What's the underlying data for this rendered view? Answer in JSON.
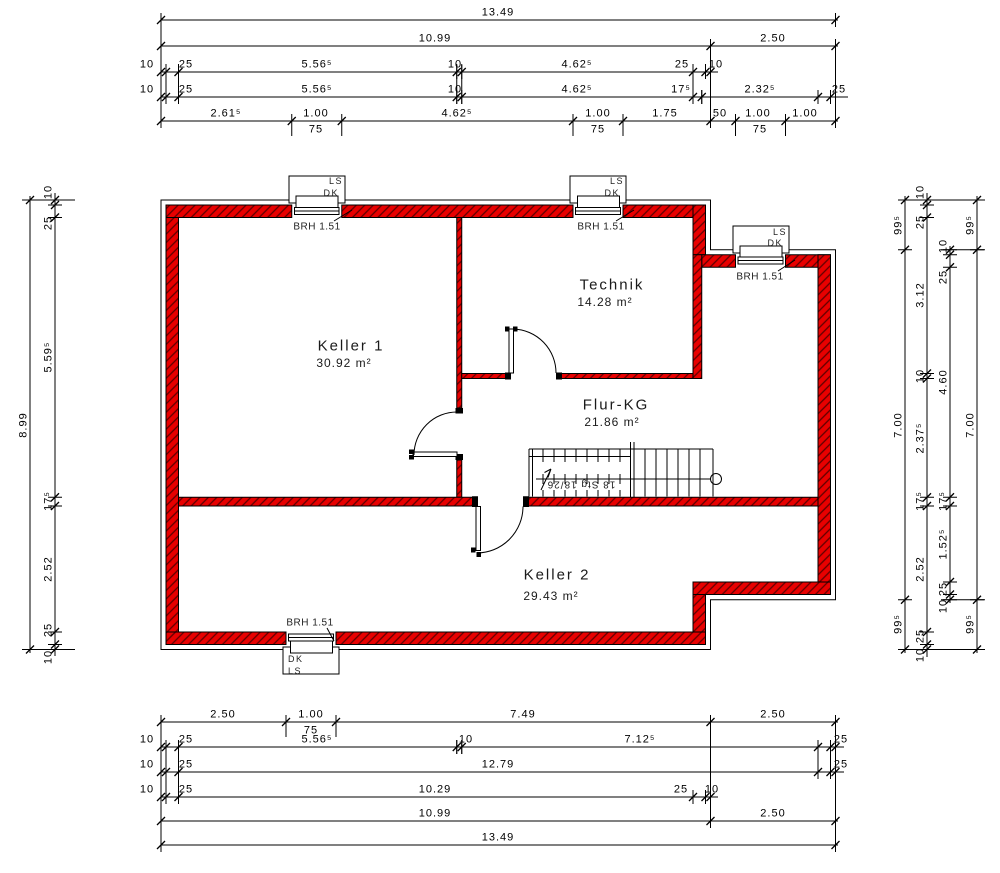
{
  "colors": {
    "wall_red": "#e80000",
    "hatch_stroke": "#600000",
    "line_black": "#000000",
    "background": "#ffffff"
  },
  "rooms": [
    {
      "name": "Keller 1",
      "area": "30.92 m²"
    },
    {
      "name": "Technik",
      "area": "14.28 m²"
    },
    {
      "name": "Flur-KG",
      "area": "21.86 m²"
    },
    {
      "name": "Keller 2",
      "area": "29.43 m²"
    }
  ],
  "stairs": {
    "label": "18 Stg 18/26"
  },
  "windows": [
    {
      "id": "top-keller1",
      "label_top": "LS",
      "label_bottom": "DK",
      "note": "BRH 1.51"
    },
    {
      "id": "top-technik",
      "label_top": "LS",
      "label_bottom": "DK",
      "note": "BRH 1.51"
    },
    {
      "id": "right-flur",
      "label_top": "LS",
      "label_bottom": "DK",
      "note": "BRH 1.51"
    },
    {
      "id": "bottom-keller2",
      "label_top": "DK",
      "label_bottom": "LS",
      "note": "BRH 1.51"
    }
  ],
  "dim_labels": [
    {
      "t": "13.49",
      "x": 498,
      "y": 13
    },
    {
      "t": "10.99",
      "x": 435,
      "y": 39
    },
    {
      "t": "2.50",
      "x": 773,
      "y": 39
    },
    {
      "t": "10",
      "x": 147,
      "y": 65
    },
    {
      "t": "25",
      "x": 186,
      "y": 65
    },
    {
      "t": "5.56⁵",
      "x": 317,
      "y": 65
    },
    {
      "t": "10",
      "x": 455,
      "y": 65
    },
    {
      "t": "4.62⁵",
      "x": 577,
      "y": 65
    },
    {
      "t": "25",
      "x": 682,
      "y": 65
    },
    {
      "t": "10",
      "x": 716,
      "y": 65
    },
    {
      "t": "10",
      "x": 147,
      "y": 90
    },
    {
      "t": "25",
      "x": 186,
      "y": 90
    },
    {
      "t": "5.56⁵",
      "x": 317,
      "y": 90
    },
    {
      "t": "10",
      "x": 455,
      "y": 90
    },
    {
      "t": "4.62⁵",
      "x": 577,
      "y": 90
    },
    {
      "t": "17⁵",
      "x": 681,
      "y": 90
    },
    {
      "t": "2.32⁵",
      "x": 760,
      "y": 90
    },
    {
      "t": "25",
      "x": 839,
      "y": 90
    },
    {
      "t": "2.61⁵",
      "x": 226,
      "y": 114
    },
    {
      "t": "1.00",
      "x": 316,
      "y": 114
    },
    {
      "t": "4.62⁵",
      "x": 457,
      "y": 114
    },
    {
      "t": "1.00",
      "x": 598,
      "y": 114
    },
    {
      "t": "1.75",
      "x": 665,
      "y": 114
    },
    {
      "t": "50",
      "x": 720,
      "y": 114
    },
    {
      "t": "1.00",
      "x": 758,
      "y": 114
    },
    {
      "t": "1.00",
      "x": 805,
      "y": 114
    },
    {
      "t": "75",
      "x": 316,
      "y": 130
    },
    {
      "t": "75",
      "x": 598,
      "y": 130
    },
    {
      "t": "75",
      "x": 760,
      "y": 130
    },
    {
      "t": "2.50",
      "x": 223,
      "y": 715
    },
    {
      "t": "1.00",
      "x": 311,
      "y": 715
    },
    {
      "t": "7.49",
      "x": 523,
      "y": 715
    },
    {
      "t": "2.50",
      "x": 773,
      "y": 715
    },
    {
      "t": "75",
      "x": 311,
      "y": 731
    },
    {
      "t": "10",
      "x": 147,
      "y": 740
    },
    {
      "t": "25",
      "x": 186,
      "y": 740
    },
    {
      "t": "5.56⁵",
      "x": 317,
      "y": 740
    },
    {
      "t": "10",
      "x": 466,
      "y": 740
    },
    {
      "t": "7.12⁵",
      "x": 640,
      "y": 740
    },
    {
      "t": "25",
      "x": 841,
      "y": 740
    },
    {
      "t": "10",
      "x": 147,
      "y": 765
    },
    {
      "t": "25",
      "x": 186,
      "y": 765
    },
    {
      "t": "12.79",
      "x": 498,
      "y": 765
    },
    {
      "t": "25",
      "x": 841,
      "y": 765
    },
    {
      "t": "10",
      "x": 147,
      "y": 790
    },
    {
      "t": "25",
      "x": 186,
      "y": 790
    },
    {
      "t": "10.29",
      "x": 435,
      "y": 790
    },
    {
      "t": "25",
      "x": 681,
      "y": 790
    },
    {
      "t": "10",
      "x": 712,
      "y": 790
    },
    {
      "t": "10.99",
      "x": 435,
      "y": 814
    },
    {
      "t": "2.50",
      "x": 773,
      "y": 814
    },
    {
      "t": "13.49",
      "x": 498,
      "y": 838
    },
    {
      "t": "8.99",
      "x": 24,
      "y": 425,
      "r": -90
    },
    {
      "t": "10",
      "x": 49,
      "y": 192,
      "r": -90
    },
    {
      "t": "25",
      "x": 49,
      "y": 223,
      "r": -90
    },
    {
      "t": "5.59⁵",
      "x": 49,
      "y": 357,
      "r": -90
    },
    {
      "t": "17⁵",
      "x": 49,
      "y": 501,
      "r": -90
    },
    {
      "t": "2.52",
      "x": 49,
      "y": 569,
      "r": -90
    },
    {
      "t": "25",
      "x": 49,
      "y": 630,
      "r": -90
    },
    {
      "t": "10",
      "x": 49,
      "y": 657,
      "r": -90
    },
    {
      "t": "99⁵",
      "x": 899,
      "y": 225,
      "r": -90
    },
    {
      "t": "7.00",
      "x": 899,
      "y": 425,
      "r": -90
    },
    {
      "t": "99⁵",
      "x": 899,
      "y": 624,
      "r": -90
    },
    {
      "t": "10",
      "x": 921,
      "y": 192,
      "r": -90
    },
    {
      "t": "25",
      "x": 921,
      "y": 222,
      "r": -90
    },
    {
      "t": "3.12",
      "x": 921,
      "y": 295,
      "r": -90
    },
    {
      "t": "10",
      "x": 921,
      "y": 376,
      "r": -90
    },
    {
      "t": "2.37⁵",
      "x": 921,
      "y": 438,
      "r": -90
    },
    {
      "t": "17⁵",
      "x": 921,
      "y": 501,
      "r": -90
    },
    {
      "t": "2.52",
      "x": 921,
      "y": 569,
      "r": -90
    },
    {
      "t": "25",
      "x": 921,
      "y": 636,
      "r": -90
    },
    {
      "t": "10",
      "x": 921,
      "y": 655,
      "r": -90
    },
    {
      "t": "10",
      "x": 944,
      "y": 246,
      "r": -90
    },
    {
      "t": "25",
      "x": 944,
      "y": 277,
      "r": -90
    },
    {
      "t": "4.60",
      "x": 944,
      "y": 382,
      "r": -90
    },
    {
      "t": "17⁵",
      "x": 944,
      "y": 501,
      "r": -90
    },
    {
      "t": "1.52⁵",
      "x": 944,
      "y": 544,
      "r": -90
    },
    {
      "t": "25",
      "x": 944,
      "y": 589,
      "r": -90
    },
    {
      "t": "10",
      "x": 944,
      "y": 606,
      "r": -90
    },
    {
      "t": "99⁵",
      "x": 971,
      "y": 225,
      "r": -90
    },
    {
      "t": "7.00",
      "x": 971,
      "y": 425,
      "r": -90
    },
    {
      "t": "99⁵",
      "x": 971,
      "y": 624,
      "r": -90
    }
  ]
}
